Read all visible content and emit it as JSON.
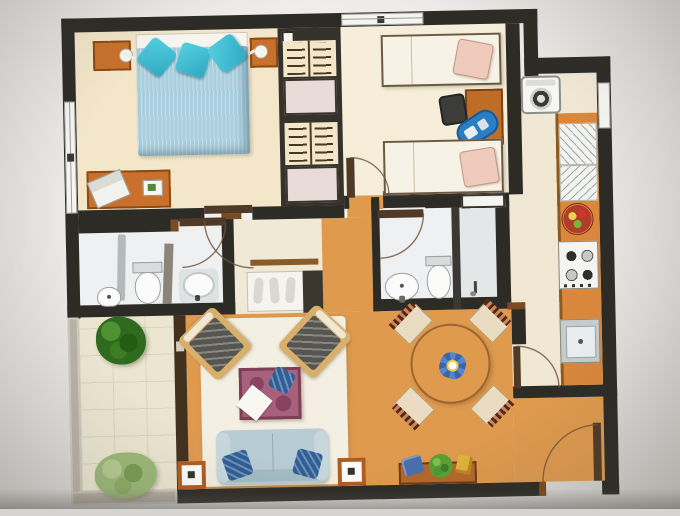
{
  "image": {
    "type": "hand-drawn apartment floor plan photograph",
    "width_px": 680,
    "height_px": 509,
    "visible_text": "none"
  },
  "palette": {
    "wall_black": "#2d2b26",
    "wood_furniture": "#c9712c",
    "kitchen_counter": "#d8873b",
    "living_floor_orange": "#df9a4e",
    "bedroom1_floor": "#f3e6c9",
    "bedroom2_floor": "#f6eed9",
    "hall_floor": "#f0e9d6",
    "bath_floor": "#eef0f1",
    "balcony_tile": "#ece6d1",
    "rug_cream": "#f2eee0",
    "duvet_blue": "#a9cedd",
    "pillow_teal": "#3fc0d4",
    "bed_linen_white": "#f6f2e6",
    "pillow_pink": "#eecbbc",
    "sofa_blue": "#b7ccd4",
    "sofa_pillow_navy": "#2f5f96",
    "coffee_table_mauve": "#a8617c",
    "dining_table_wood": "#cd9050",
    "flower_blue": "#3a66b0",
    "plant_dark_green": "#3e7d2c",
    "plant_light_green": "#9cb878",
    "balcony_wall_gray": "#b9b3a7",
    "door_arc_brown": "#70543a"
  },
  "rooms": [
    {
      "id": "bedroom-1",
      "label": "bedroom 1 (double)",
      "furniture": [
        "double bed with blue duvet",
        "3 teal pillows",
        "left nightstand with lamp",
        "right nightstand with lamp",
        "desk with laptop and green notebook"
      ]
    },
    {
      "id": "wardrobe-column",
      "label": "built-in wardrobes",
      "furniture": [
        "hanger rail unit x2",
        "shelf box x2"
      ]
    },
    {
      "id": "bedroom-2",
      "label": "bedroom 2 (twin)",
      "furniture": [
        "single bed x2",
        "pink pillow x2",
        "desk",
        "dark office chair",
        "blue bag"
      ]
    },
    {
      "id": "bathroom-1",
      "label": "bathroom 1",
      "furniture": [
        "pedestal sink",
        "toilet",
        "shower screen",
        "round shower tray"
      ]
    },
    {
      "id": "bathroom-2",
      "label": "bathroom 2",
      "furniture": [
        "washbasin",
        "toilet",
        "shower stall",
        "wall niche"
      ]
    },
    {
      "id": "kitchen",
      "label": "galley kitchen",
      "furniture": [
        "washing machine",
        "dish rack x2",
        "fruit bowl",
        "4-burner stove",
        "sink"
      ]
    },
    {
      "id": "hallway",
      "label": "hallway",
      "furniture": [
        "wall shelf",
        "shoe rack",
        "tall cabinet"
      ]
    },
    {
      "id": "living-room",
      "label": "living room",
      "furniture": [
        "cream rug",
        "armchair x2",
        "mauve coffee table with white cloth and navy cushion",
        "3-seat blue sofa with 2 navy pillows",
        "square side table x2"
      ]
    },
    {
      "id": "dining-area",
      "label": "dining area",
      "furniture": [
        "round wooden table",
        "chair x4",
        "blue flower centerpiece",
        "sideboard with blue cushion, green plant, yellow object"
      ]
    },
    {
      "id": "balcony",
      "label": "balcony",
      "furniture": [
        "dark green plant",
        "light green plant",
        "tiled floor"
      ]
    },
    {
      "id": "entry",
      "label": "entrance",
      "furniture": [
        "entry door with swing arc"
      ]
    }
  ],
  "doors": [
    "bedroom-1",
    "bedroom-2",
    "bathroom-1",
    "bathroom-2",
    "kitchen",
    "entry"
  ],
  "windows": [
    "bedroom-1 left wall (double casement)",
    "bedroom-2 top wall",
    "kitchen right wall"
  ]
}
